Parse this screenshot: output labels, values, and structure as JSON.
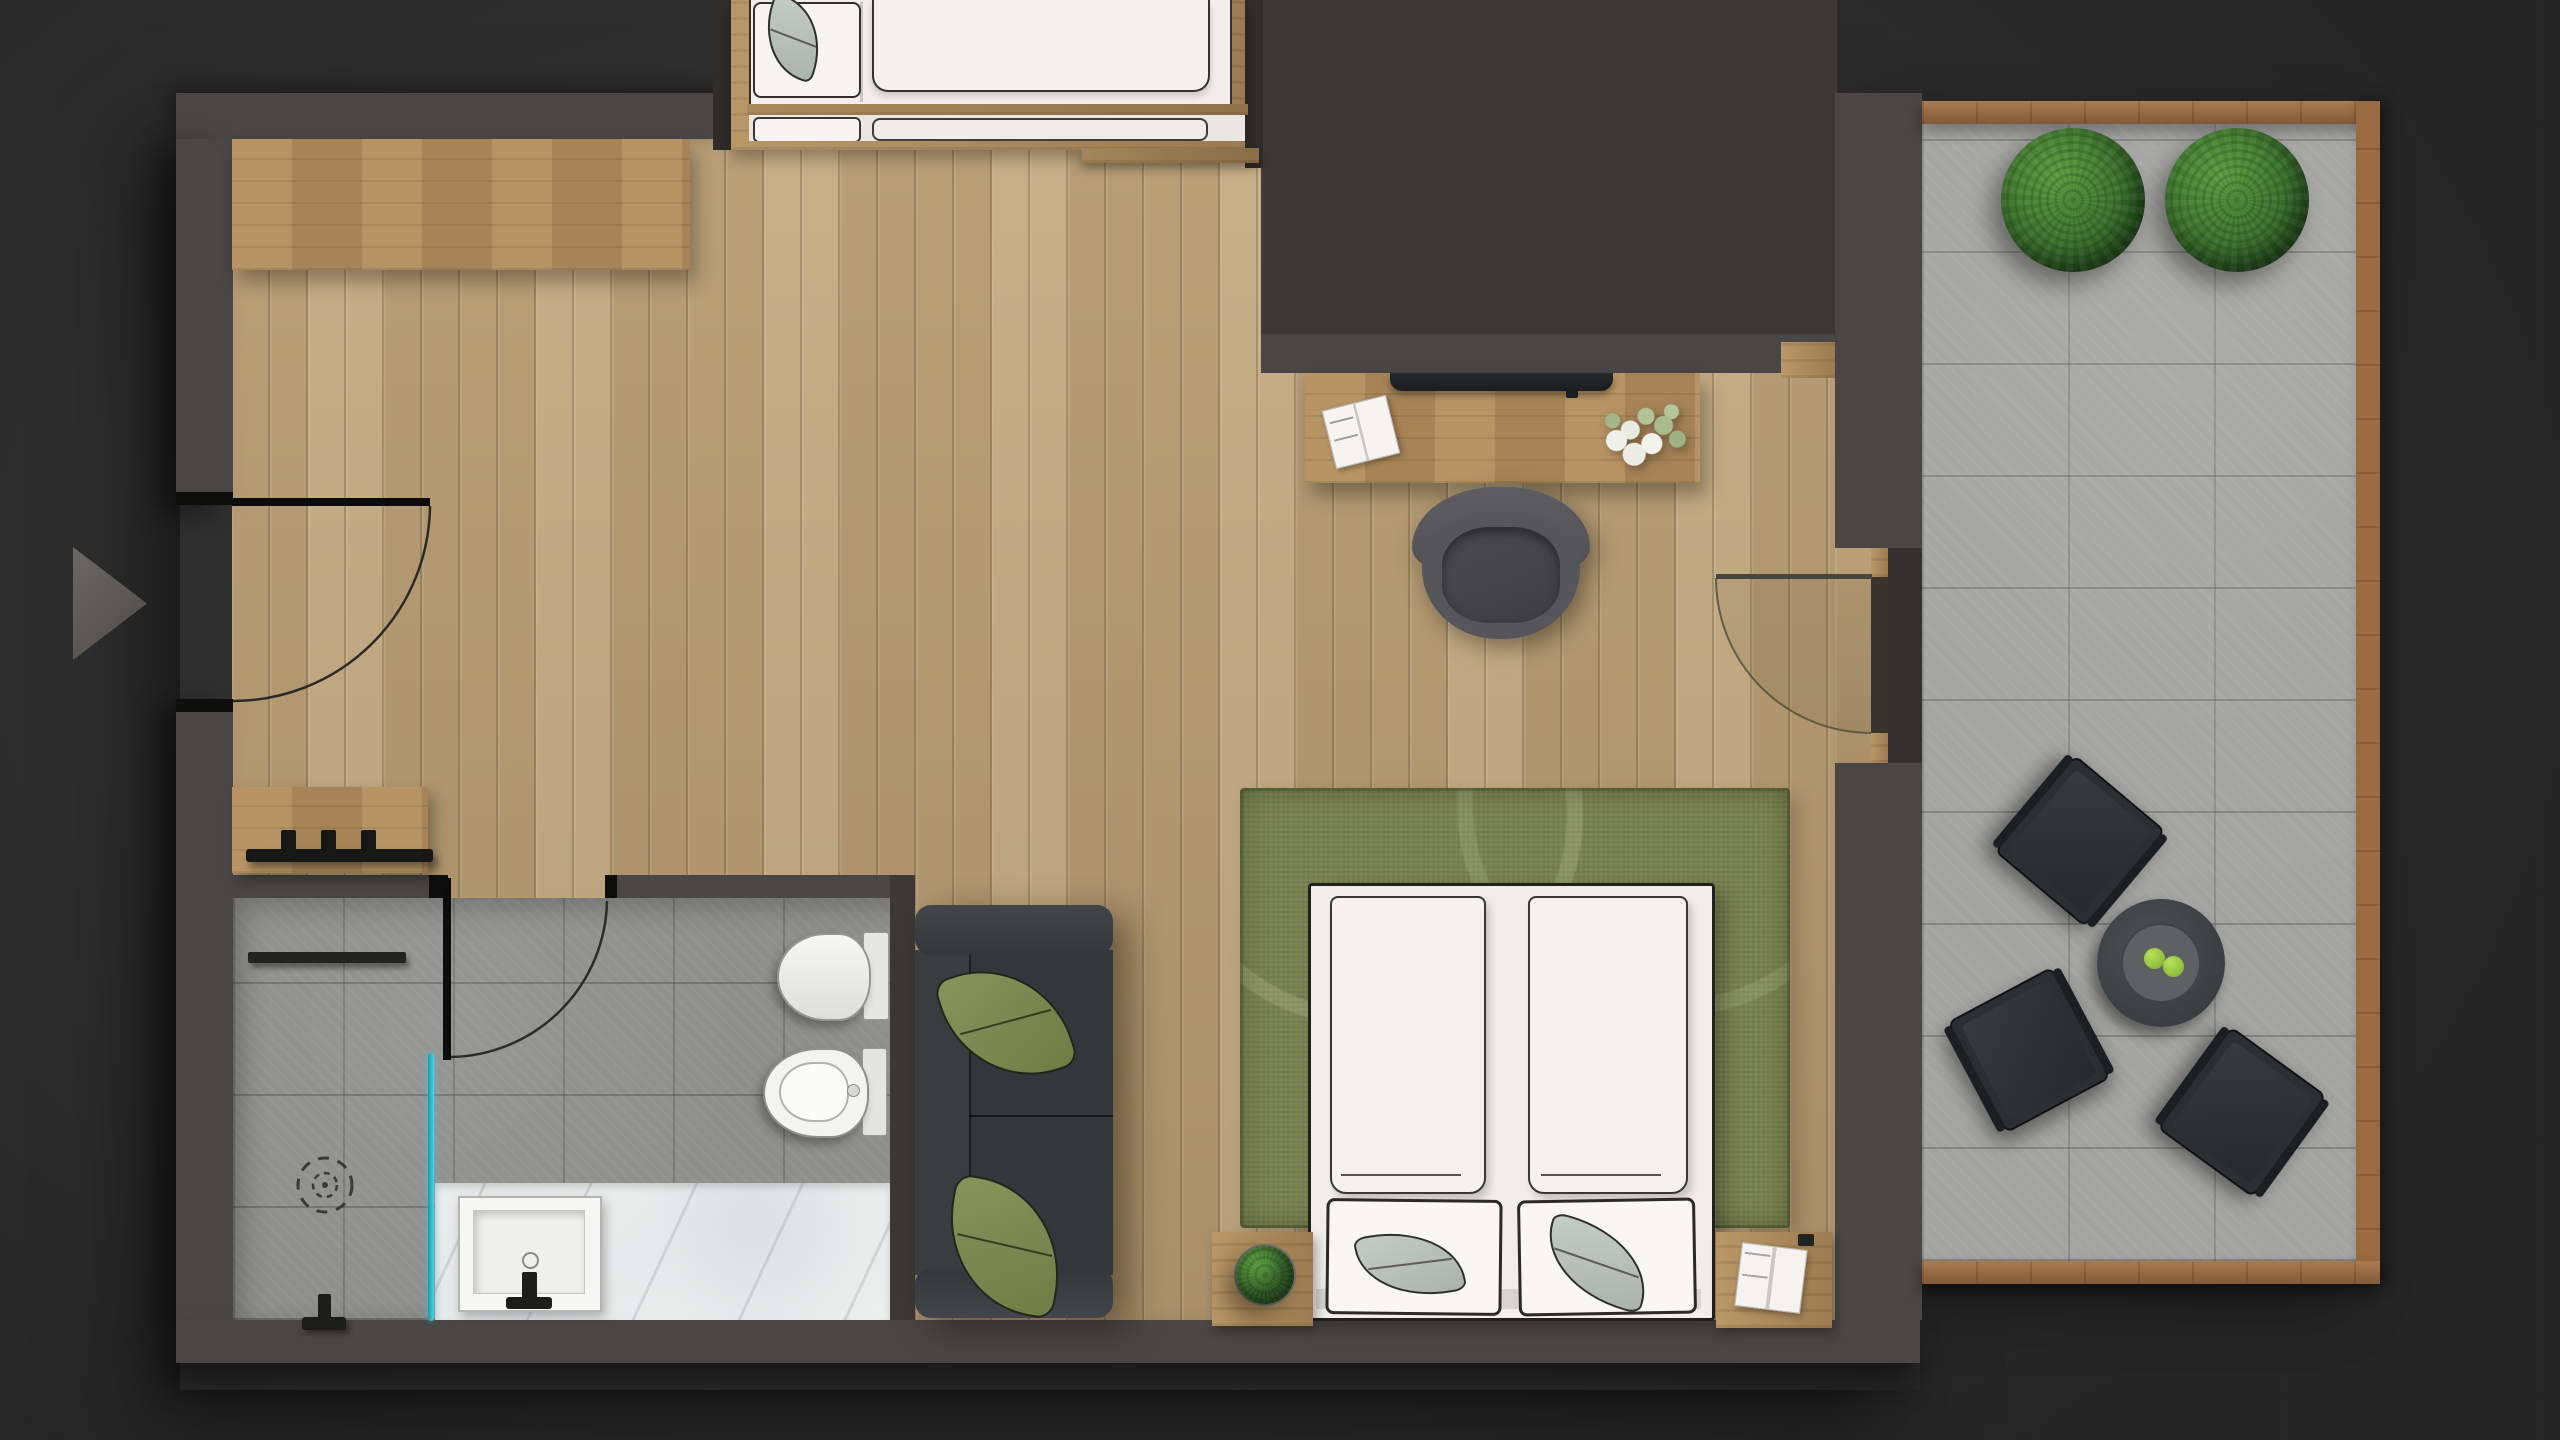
{
  "title": "Studio apartment floor plan — top-down render",
  "colors": {
    "background": "#2f2e2d",
    "wall": "#4a4645",
    "wood_floor": "#bda378",
    "bathroom_tile": "#8e8e8c",
    "balcony_tile": "#a3a3a1",
    "glass_accent": "#2cb7ca",
    "rug_green": "#78824f",
    "sofa_charcoal": "#34373a",
    "outdoor_charcoal": "#2c2f31",
    "apple_green": "#90c83e"
  },
  "rooms": [
    {
      "label": "Living area"
    },
    {
      "label": "Sleeping alcove"
    },
    {
      "label": "Workspace"
    },
    {
      "label": "Entry"
    },
    {
      "label": "Bathroom"
    },
    {
      "label": "Balcony"
    }
  ],
  "furniture": {
    "wardrobe": "Wardrobe cabinet",
    "alcove_bed": "Alcove bed with bench",
    "console": "Entry console with coat hooks",
    "entry_door": "Entry door swing",
    "bathroom_door": "Bathroom door swing",
    "balcony_door": "Balcony door swing",
    "towel_bar": "Towel bar",
    "shower_head": "Shower head",
    "drain": "Shower drain",
    "glass": "Shower glass partition",
    "toilet": "Toilet",
    "bidet": "Bidet",
    "vanity": "Marble vanity",
    "sink": "Washbasin",
    "sofa": "Charcoal sofa with pillows",
    "rug": "Green area rug",
    "bed": "Double bed with pillows",
    "plant_table": "Plant stand",
    "nightstand": "Nightstand with book",
    "desk": "Desk",
    "monitor": "Monitor",
    "desk_chair": "Desk chair",
    "flowers": "Flower bouquet",
    "magazine": "Open magazine",
    "balcony_plant_1": "Boxwood planter",
    "balcony_plant_2": "Boxwood planter",
    "outdoor_chair": "Outdoor lounge chair",
    "coffee_table": "Round coffee table with apples",
    "marker": "Direction arrow marker"
  }
}
